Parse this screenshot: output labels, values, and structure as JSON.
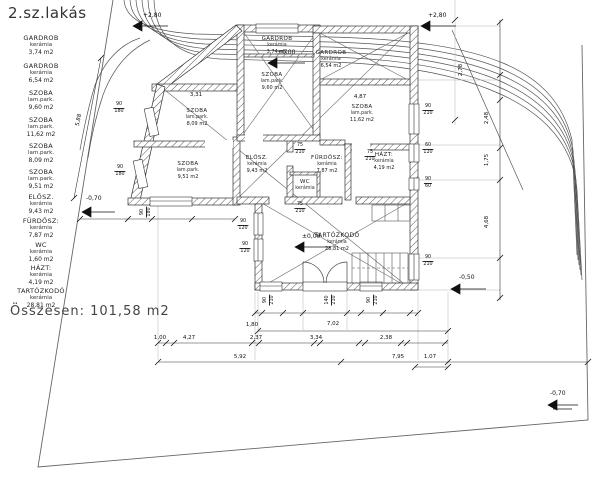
{
  "title": "2.sz.lakás",
  "legend": {
    "rooms": [
      {
        "name": "GARDROB",
        "finish": "kerámia",
        "area": "3,74  m2"
      },
      {
        "name": "GARDROB",
        "finish": "kerámia",
        "area": "6,54  m2"
      },
      {
        "name": "SZOBA",
        "finish": "lam.park.",
        "area": "9,60  m2"
      },
      {
        "name": "SZOBA",
        "finish": "lam.park.",
        "area": "11,62  m2"
      },
      {
        "name": "SZOBA",
        "finish": "lam.park.",
        "area": "8,09  m2"
      },
      {
        "name": "SZOBA",
        "finish": "lam.park.",
        "area": "9,51  m2"
      },
      {
        "name": "ELŐSZ.",
        "finish": "kerámia",
        "area": "9,43  m2"
      },
      {
        "name": "FÜRDŐSZ:",
        "finish": "kerámia",
        "area": "7,87  m2"
      },
      {
        "name": "WC",
        "finish": "kerámia",
        "area": "1,60  m2"
      },
      {
        "name": "HÁZT:",
        "finish": "kerámia",
        "area": "4,19  m2"
      },
      {
        "name": "TARTÓZKODÓ",
        "finish": "kerámia",
        "area": "28,81  m2"
      }
    ],
    "total_label": "Összesen:  101,58 m2"
  },
  "plan": {
    "levels": [
      "+2,80",
      "+2,80",
      "±0,00",
      "±0,00",
      "-0,70",
      "-0,50",
      "-0,70"
    ],
    "dims": [
      "4,27",
      "2,37",
      "3,34",
      "2,38",
      "1,07",
      "5,92",
      "7,95",
      "7,02",
      "1,80",
      "3,31",
      "4,87",
      "5,88",
      "2,48",
      "1,75",
      "4,68",
      "2,78",
      "1,00"
    ],
    "openings": [
      {
        "w": "90",
        "h": "210"
      },
      {
        "w": "60",
        "h": "120"
      },
      {
        "w": "90",
        "h": "60"
      },
      {
        "w": "90",
        "h": "210"
      },
      {
        "w": "90",
        "h": "180"
      },
      {
        "w": "90",
        "h": "180"
      },
      {
        "w": "90",
        "h": "180"
      },
      {
        "w": "90",
        "h": "210"
      },
      {
        "w": "140",
        "h": "210"
      },
      {
        "w": "90",
        "h": "210"
      },
      {
        "w": "90",
        "h": "120"
      },
      {
        "w": "90",
        "h": "120"
      },
      {
        "w": "75",
        "h": "210"
      },
      {
        "w": "75",
        "h": "210"
      },
      {
        "w": "75",
        "h": "210"
      }
    ]
  }
}
